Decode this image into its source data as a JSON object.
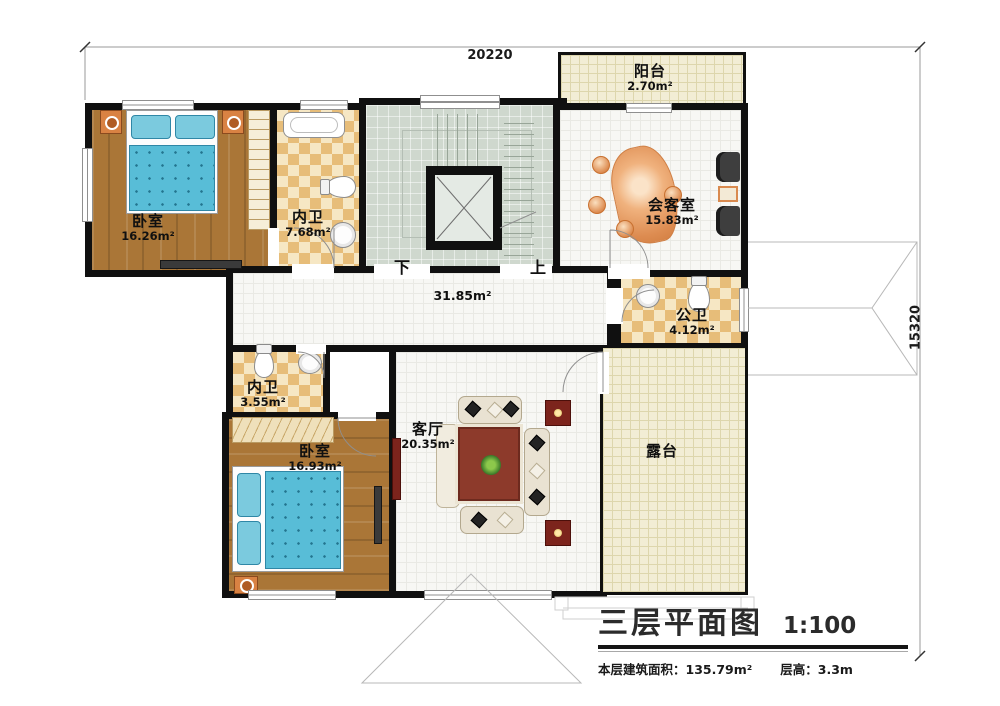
{
  "dimensions": {
    "width_label": "20220",
    "height_label": "15320"
  },
  "rooms": {
    "balcony": {
      "name": "阳台",
      "area": "2.70m²"
    },
    "bedroom_top": {
      "name": "卧室",
      "area": "16.26m²"
    },
    "bath_top": {
      "name": "内卫",
      "area": "7.68m²"
    },
    "reception": {
      "name": "会客室",
      "area": "15.83m²"
    },
    "corridor": {
      "area": "31.85m²"
    },
    "public_bath": {
      "name": "公卫",
      "area": "4.12m²"
    },
    "bath_bottom": {
      "name": "内卫",
      "area": "3.55m²"
    },
    "bedroom_bottom": {
      "name": "卧室",
      "area": "16.93m²"
    },
    "living": {
      "name": "客厅",
      "area": "20.35m²"
    },
    "terrace": {
      "name": "露台"
    }
  },
  "stairs": {
    "down_label": "下",
    "up_label": "上"
  },
  "title_block": {
    "title": "三层平面图",
    "scale": "1:100",
    "area_label": "本层建筑面积：135.79m²",
    "floor_height_label": "层高：3.3m"
  },
  "colors": {
    "wall": "#101010",
    "wood": "#aa7637",
    "tile_a": "#e7bd79",
    "tile_b": "#f6e7c4",
    "floor_gray": "#cfd8ce",
    "floor_white": "#f7f7f4",
    "floor_beige": "#f2edd5",
    "bed_blue": "#58bdd7",
    "sofa_orange": "#dd8c51",
    "rug_red": "#8d3a2b"
  }
}
